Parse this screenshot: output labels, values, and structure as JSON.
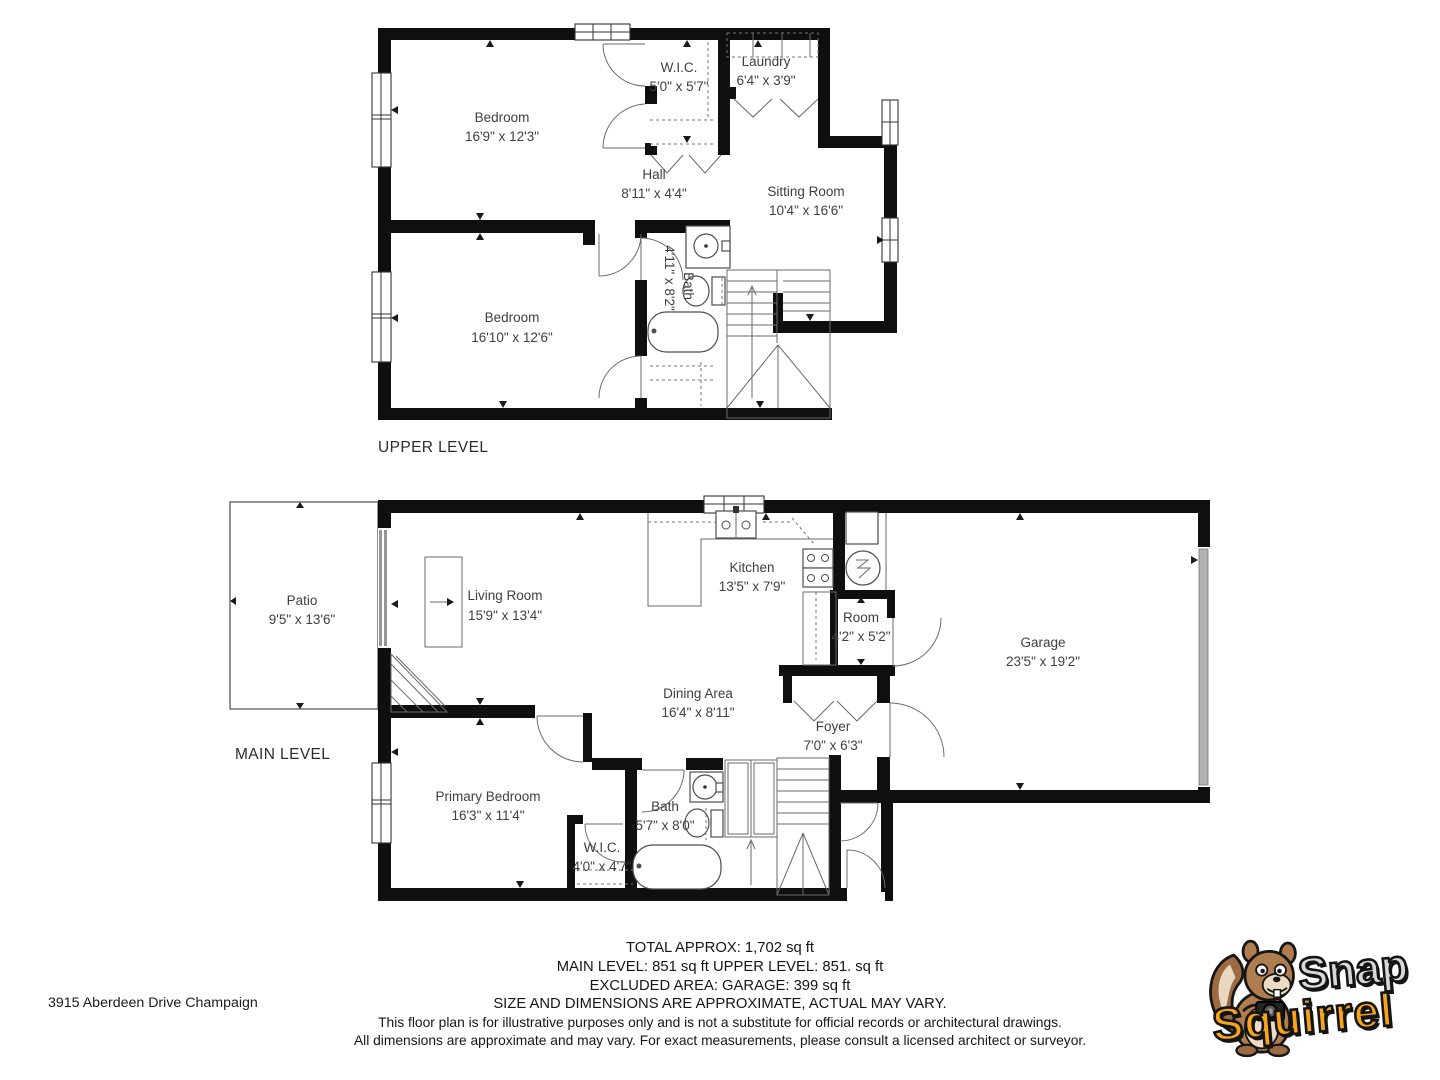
{
  "upper_level": {
    "label": "UPPER LEVEL",
    "rooms": {
      "bedroom1": {
        "name": "Bedroom",
        "dims": "16'9\" x 12'3\""
      },
      "wic": {
        "name": "W.I.C.",
        "dims": "5'0\" x 5'7\""
      },
      "laundry": {
        "name": "Laundry",
        "dims": "6'4\" x 3'9\""
      },
      "hall": {
        "name": "Hall",
        "dims": "8'11\" x 4'4\""
      },
      "sitting": {
        "name": "Sitting Room",
        "dims": "10'4\" x 16'6\""
      },
      "bath": {
        "name": "Bath",
        "dims": "4'11\" x 8'2\""
      },
      "bedroom2": {
        "name": "Bedroom",
        "dims": "16'10\" x 12'6\""
      }
    }
  },
  "main_level": {
    "label": "MAIN LEVEL",
    "rooms": {
      "patio": {
        "name": "Patio",
        "dims": "9'5\" x 13'6\""
      },
      "living": {
        "name": "Living Room",
        "dims": "15'9\" x 13'4\""
      },
      "kitchen": {
        "name": "Kitchen",
        "dims": "13'5\" x 7'9\""
      },
      "room": {
        "name": "Room",
        "dims": "4'2\" x 5'2\""
      },
      "garage": {
        "name": "Garage",
        "dims": "23'5\" x 19'2\""
      },
      "dining": {
        "name": "Dining Area",
        "dims": "16'4\" x 8'11\""
      },
      "foyer": {
        "name": "Foyer",
        "dims": "7'0\" x 6'3\""
      },
      "primary": {
        "name": "Primary Bedroom",
        "dims": "16'3\" x 11'4\""
      },
      "bath": {
        "name": "Bath",
        "dims": "5'7\" x 8'0\""
      },
      "wic": {
        "name": "W.I.C.",
        "dims": "4'0\" x 4'7\""
      }
    }
  },
  "footer": {
    "address": "3915 Aberdeen Drive Champaign",
    "total": "TOTAL APPROX: 1,702 sq ft",
    "levels": "MAIN LEVEL: 851 sq ft UPPER LEVEL: 851. sq ft",
    "excluded": "EXCLUDED AREA: GARAGE: 399 sq ft",
    "approx_note": "SIZE AND DIMENSIONS ARE APPROXIMATE, ACTUAL MAY VARY.",
    "disclaimer1": "This floor plan is for illustrative purposes only and is not a substitute for official records or architectural drawings.",
    "disclaimer2": "All dimensions are approximate and may vary. For exact measurements, please consult a licensed architect or surveyor."
  },
  "logo": {
    "word1": "Snap",
    "word2": "Squirrel",
    "word1_color": "#d8d8d8",
    "word2_color": "#f7a41d"
  }
}
